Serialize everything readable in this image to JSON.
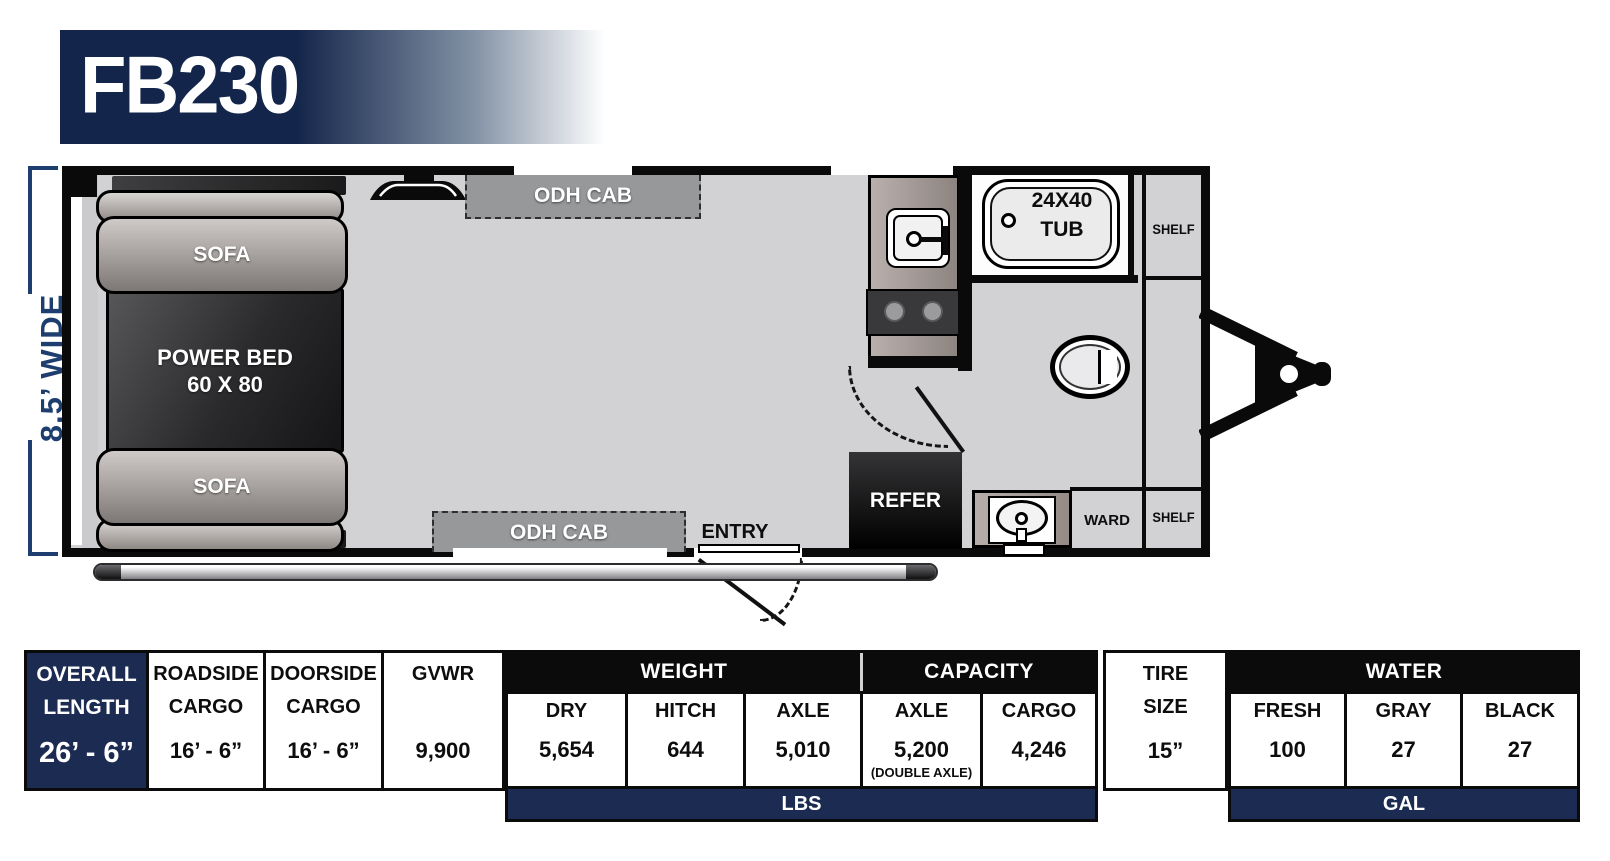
{
  "model": "FB230",
  "plan": {
    "width_label": "8.5’ WIDE",
    "labels": {
      "sofa": "SOFA",
      "power_bed_line1": "POWER BED",
      "power_bed_line2": "60 X 80",
      "odh_cab": "ODH CAB",
      "tub_size": "24X40",
      "tub": "TUB",
      "shelf": "SHELF",
      "ward": "WARD",
      "refer": "REFER",
      "entry": "ENTRY"
    }
  },
  "specs": {
    "overall": {
      "label_line1": "OVERALL",
      "label_line2": "LENGTH",
      "value": "26’ - 6”"
    },
    "roadside": {
      "label_line1": "ROADSIDE",
      "label_line2": "CARGO",
      "value": "16’ - 6”"
    },
    "doorside": {
      "label_line1": "DOORSIDE",
      "label_line2": "CARGO",
      "value": "16’ - 6”"
    },
    "gvwr": {
      "label": "GVWR",
      "value": "9,900"
    },
    "weight": {
      "header": "WEIGHT",
      "dry_label": "DRY",
      "dry_value": "5,654",
      "hitch_label": "HITCH",
      "hitch_value": "644",
      "axle_label": "AXLE",
      "axle_value": "5,010",
      "unit": "LBS"
    },
    "capacity": {
      "header": "CAPACITY",
      "axle_label": "AXLE",
      "axle_value": "5,200",
      "axle_note": "(DOUBLE AXLE)",
      "cargo_label": "CARGO",
      "cargo_value": "4,246"
    },
    "tire": {
      "label_line1": "TIRE",
      "label_line2": "SIZE",
      "value": "15”"
    },
    "water": {
      "header": "WATER",
      "fresh_label": "FRESH",
      "fresh_value": "100",
      "gray_label": "GRAY",
      "gray_value": "27",
      "black_label": "BLACK",
      "black_value": "27",
      "unit": "GAL"
    }
  },
  "colors": {
    "table_navy": "#1b2b52",
    "banner_navy": "#13254a",
    "dimension_navy": "#1d3e6e",
    "wall_black": "#0a0a0a",
    "floor_gray": "#d2d2d4",
    "cabinet_gray": "#96989a"
  }
}
